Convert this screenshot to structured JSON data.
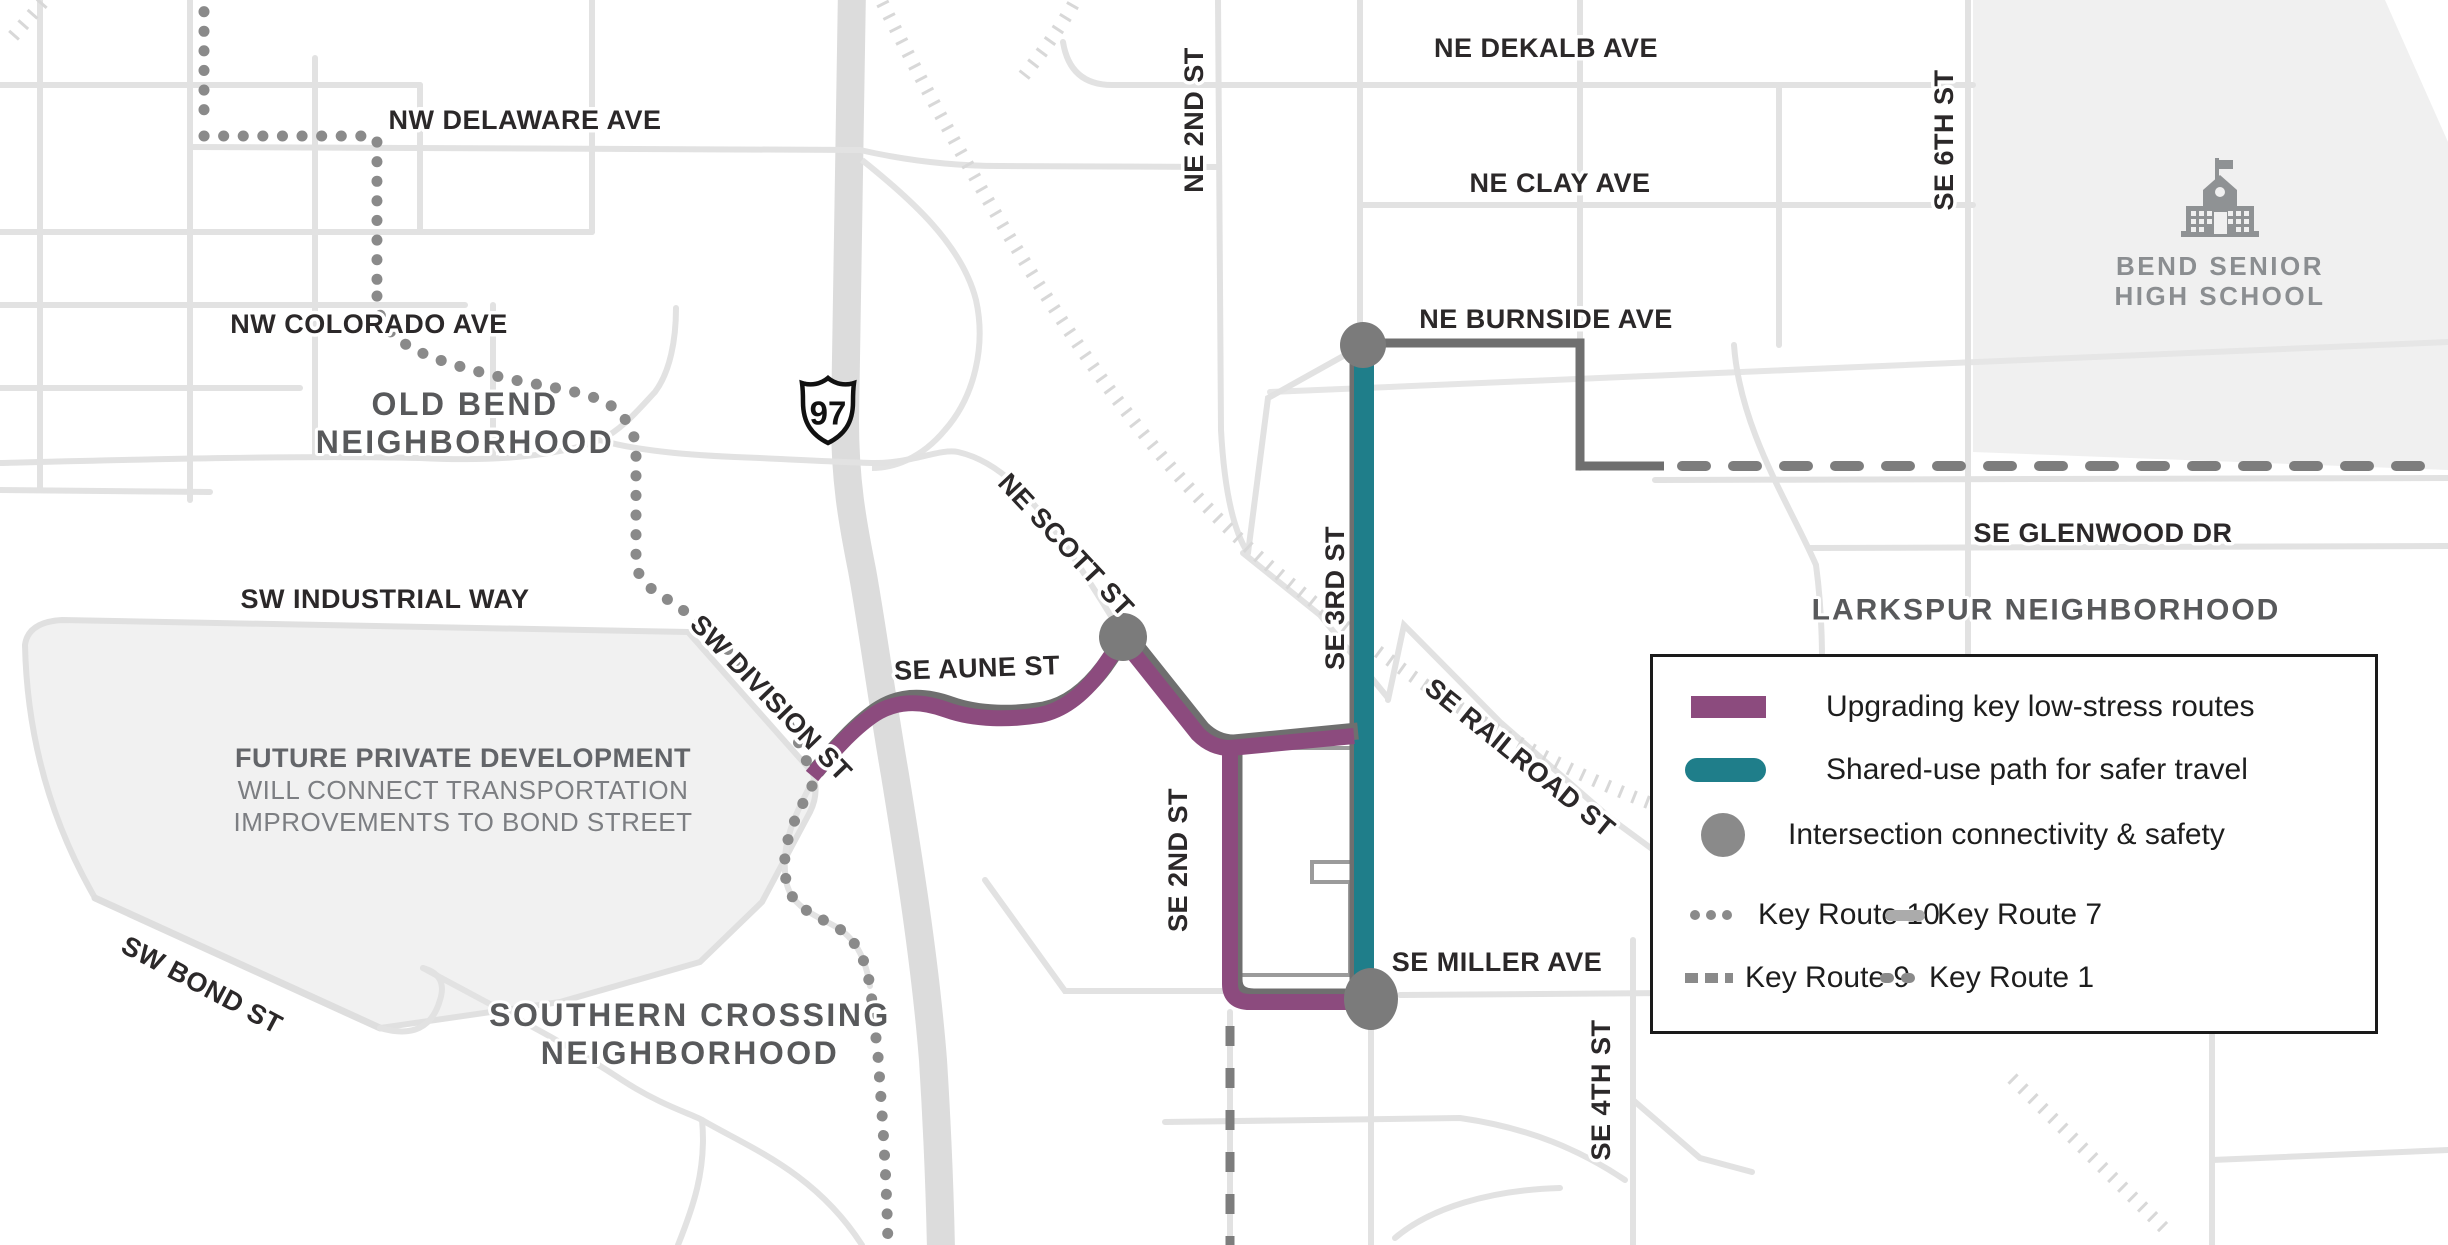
{
  "legend": {
    "items": [
      {
        "icon": "purple-route-swatch",
        "label": "Upgrading key low-stress routes"
      },
      {
        "icon": "teal-path-swatch",
        "label": "Shared-use path for safer travel"
      },
      {
        "icon": "intersection-circle-swatch",
        "label": "Intersection connectivity & safety"
      }
    ],
    "key_routes": [
      {
        "icon": "dotted-line-swatch",
        "label": "Key Route 10"
      },
      {
        "icon": "solid-gray-swatch",
        "label": "Key Route 7"
      },
      {
        "icon": "square-dash-swatch",
        "label": "Key Route 9"
      },
      {
        "icon": "round-dash-swatch",
        "label": "Key Route 1"
      }
    ]
  },
  "labels": {
    "nw_delaware_ave": "NW DELAWARE AVE",
    "nw_colorado_ave": "NW COLORADO AVE",
    "sw_industrial_way": "SW INDUSTRIAL WAY",
    "sw_division_st": "SW DIVISION ST",
    "se_aune_st": "SE AUNE ST",
    "ne_scott_st": "NE SCOTT ST",
    "sw_bond_st": "SW BOND ST",
    "ne_2nd_st": "NE 2ND ST",
    "ne_dekalb_ave": "NE DEKALB AVE",
    "ne_clay_ave": "NE CLAY AVE",
    "se_6th_st": "SE 6TH ST",
    "ne_burnside_ave": "NE BURNSIDE AVE",
    "se_glenwood_dr": "SE GLENWOOD DR",
    "se_railroad_st": "SE RAILROAD ST",
    "se_2nd_st": "SE 2ND ST",
    "se_3rd_st": "SE 3RD ST",
    "se_miller_ave": "SE MILLER AVE",
    "se_4th_st": "SE 4TH ST"
  },
  "neighborhoods": {
    "old_bend": [
      "OLD BEND",
      "NEIGHBORHOOD"
    ],
    "southern_crossing": [
      "SOUTHERN CROSSING",
      "NEIGHBORHOOD"
    ],
    "larkspur": "LARKSPUR NEIGHBORHOOD"
  },
  "annotations": {
    "future_development": [
      "FUTURE PRIVATE DEVELOPMENT",
      "WILL CONNECT TRANSPORTATION",
      "IMPROVEMENTS TO BOND STREET"
    ]
  },
  "poi": {
    "school_name": [
      "BEND SENIOR",
      "HIGH SCHOOL"
    ]
  },
  "highway": {
    "us97": "97"
  },
  "colors": {
    "low_stress_purple": "#8C4B7E",
    "shared_use_teal": "#1F7E8A",
    "intersection_gray": "#7b7b7b",
    "route_dark_gray": "#6f6f6f",
    "key_route_gray": "#7d7d7d",
    "dotted_route_gray": "#8a8a8a"
  }
}
